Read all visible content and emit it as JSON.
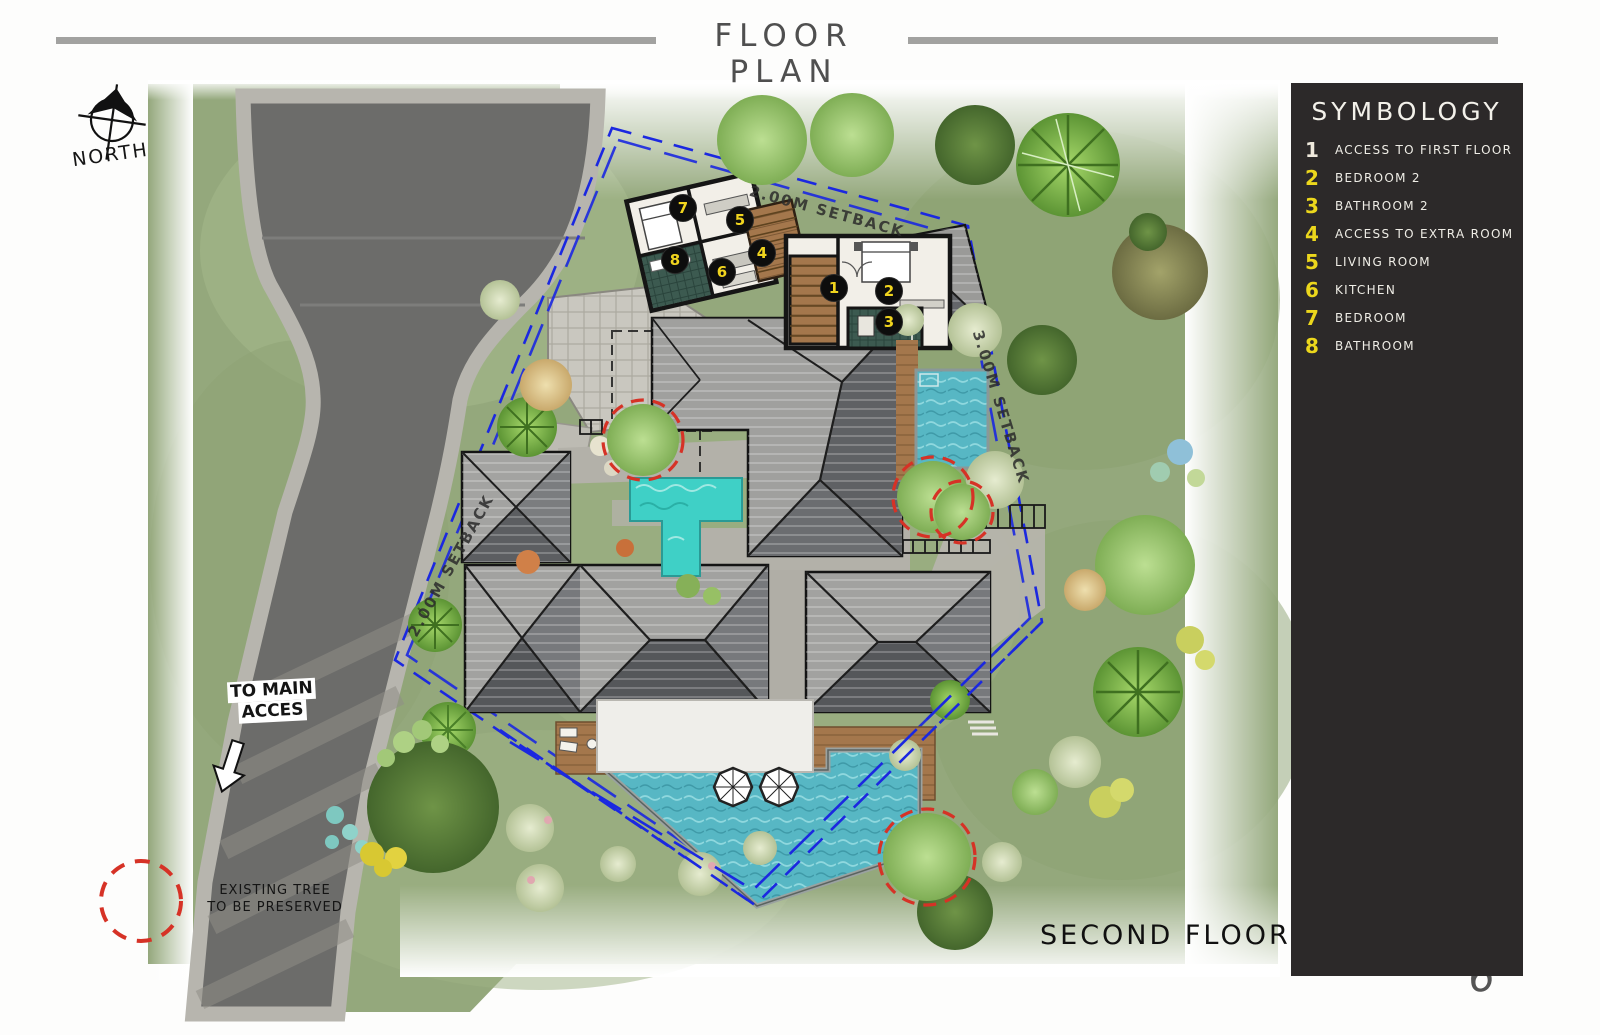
{
  "header": {
    "title": "FLOOR PLAN"
  },
  "page_number": "6",
  "floor_label": "SECOND FLOOR",
  "compass_label": "NORTH",
  "access_label": {
    "line1": "TO MAIN",
    "line2": "ACCES"
  },
  "tree_note": {
    "line1": "EXISTING TREE",
    "line2": "TO BE PRESERVED"
  },
  "setback_labels": {
    "top": "2.00M SETBACK",
    "right": "3.00M SETBACK",
    "left": "2.00M SETBACK"
  },
  "legend": {
    "title": "SYMBOLOGY",
    "items": [
      {
        "num": "1",
        "label": "ACCESS TO FIRST FLOOR",
        "num_color": "#efe9dc"
      },
      {
        "num": "2",
        "label": "BEDROOM 2",
        "num_color": "#ecd71c"
      },
      {
        "num": "3",
        "label": "BATHROOM 2",
        "num_color": "#ecd71c"
      },
      {
        "num": "4",
        "label": "ACCESS TO EXTRA ROOM",
        "num_color": "#ecd71c"
      },
      {
        "num": "5",
        "label": "LIVING ROOM",
        "num_color": "#ecd71c"
      },
      {
        "num": "6",
        "label": "KITCHEN",
        "num_color": "#ecd71c"
      },
      {
        "num": "7",
        "label": "BEDROOM",
        "num_color": "#ecd71c"
      },
      {
        "num": "8",
        "label": "BATHROOM",
        "num_color": "#ecd71c"
      }
    ]
  },
  "markers": [
    {
      "num": "1",
      "x": 834,
      "y": 288
    },
    {
      "num": "2",
      "x": 889,
      "y": 291
    },
    {
      "num": "3",
      "x": 889,
      "y": 322
    },
    {
      "num": "4",
      "x": 762,
      "y": 253
    },
    {
      "num": "5",
      "x": 740,
      "y": 220
    },
    {
      "num": "6",
      "x": 722,
      "y": 272
    },
    {
      "num": "7",
      "x": 683,
      "y": 208
    },
    {
      "num": "8",
      "x": 675,
      "y": 260
    }
  ],
  "colors": {
    "sidebar_bg": "#2c2929",
    "accent_yellow": "#ecd71c",
    "boundary_blue": "#1b28e0",
    "preserve_red": "#d63226",
    "grass": "#94a87c",
    "road": "#6c6c6a",
    "pool": "#55b7c6"
  }
}
